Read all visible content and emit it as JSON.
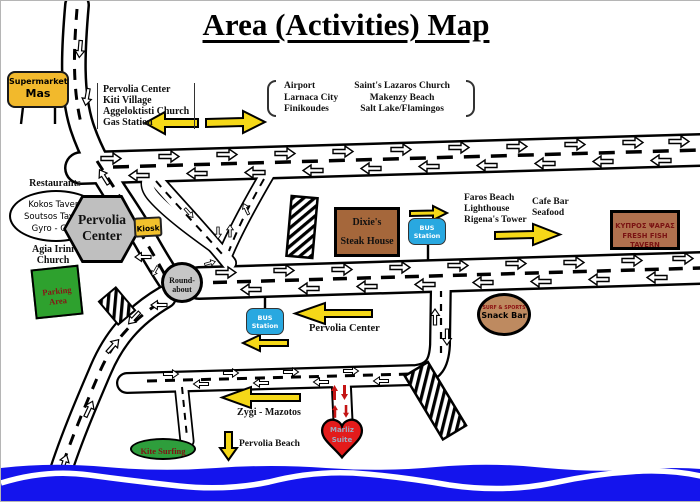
{
  "labels": {
    "title": "Area (Activities) Map",
    "supermarket": [
      "Supermarket",
      "Mas"
    ],
    "nw_sign": [
      "Pervolia Center",
      "Kiti Village",
      "Aggeloktisti Church",
      "Gas Station"
    ],
    "ne_sign_left": [
      "Airport",
      "Larnaca City",
      "Finikoudes"
    ],
    "ne_sign_right": [
      "Saint's Lazaros Church",
      "Makenzy Beach",
      "Salt Lake/Flamingos"
    ],
    "restaurants_title": "Restaurants",
    "restaurants": [
      "Kokos Tavern",
      "Soutsos Tavern",
      "Gyro - Gyro"
    ],
    "pervolia_hex": [
      "Pervolia",
      "Center"
    ],
    "kiosk": "Kiosk",
    "agia_irini": [
      "Agia Irini",
      "Church"
    ],
    "parking": [
      "Parking",
      "Area"
    ],
    "roundabout": [
      "Round-",
      "about"
    ],
    "dixies": [
      "Dixie's",
      "Steak House"
    ],
    "bus_station": [
      "BUS",
      "Station"
    ],
    "faros_sign": [
      "Faros Beach",
      "Lighthouse",
      "Rigena's Tower"
    ],
    "cafe_sign": [
      "Cafe Bar",
      "Seafood"
    ],
    "fish_tavern": [
      "ΚΥΠΡΟΣ ΨΑΡΑΣ",
      "FRESH FISH TAVERN"
    ],
    "snack_bar": [
      "SURF & SPORTS",
      "Snack Bar"
    ],
    "pervolia_dir": "Pervolia Center",
    "zygi": "Zygi - Mazotos",
    "pervolia_beach": "Pervolia Beach",
    "kite_surfing": "Kite Surfing",
    "marliz": [
      "Marliz",
      "Suite"
    ]
  },
  "colors": {
    "sea_blue": "#1414ED",
    "arrow_yellow": "#F5D818",
    "sign_yellow": "#F2B92C",
    "bus_blue": "#29A8E0",
    "parking_green": "#2EA12E",
    "kite_green": "#2E9E3C",
    "building_brown": "#A5673B",
    "tavern_brown": "#B0704E",
    "snack_tan": "#BE8A60",
    "heart_red": "#E31B1B",
    "roundabout_gray": "#C6C6C6"
  }
}
